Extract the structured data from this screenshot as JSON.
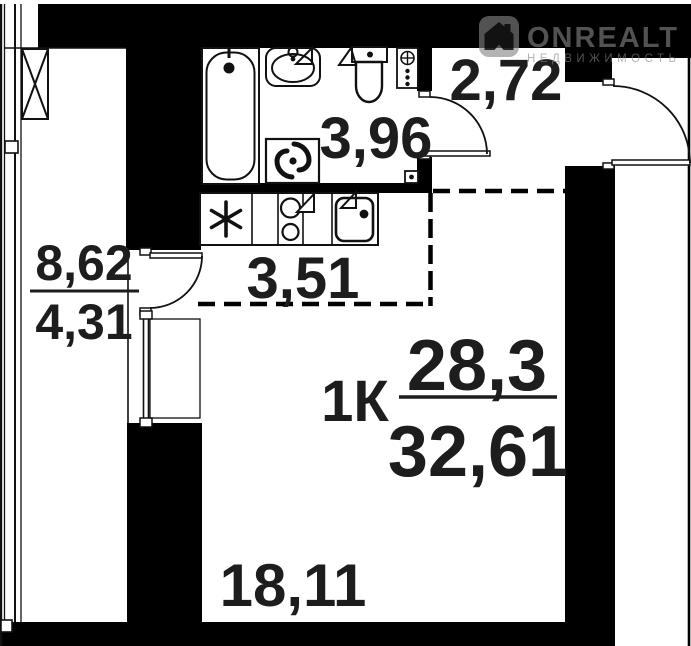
{
  "logo": {
    "brand": "ONREALT",
    "tagline": "НЕДВИЖИМОСТЬ",
    "icon": "house-icon",
    "watermark_color": "#848484"
  },
  "plan": {
    "title": "1-room apartment floor plan",
    "type_label": "1К",
    "living_area": "28,3",
    "total_area": "32,61",
    "rooms": [
      {
        "name": "hallway",
        "area": "2,72"
      },
      {
        "name": "bathroom",
        "area": "3,96"
      },
      {
        "name": "kitchen-zone",
        "area": "3,51"
      },
      {
        "name": "loggia-full",
        "area": "8,62"
      },
      {
        "name": "loggia-counted",
        "area": "4,31"
      },
      {
        "name": "living-room",
        "area": "18,11"
      }
    ],
    "fixtures": [
      "bathtub",
      "wash-basin",
      "toilet",
      "washing-machine",
      "stove",
      "kitchen-sink",
      "refrigerator-asterisk",
      "ventilation-shaft",
      "plumbing-riser"
    ],
    "colors": {
      "walls": "#000000",
      "background": "#ffffff",
      "labels": "#1d1d1d"
    }
  }
}
